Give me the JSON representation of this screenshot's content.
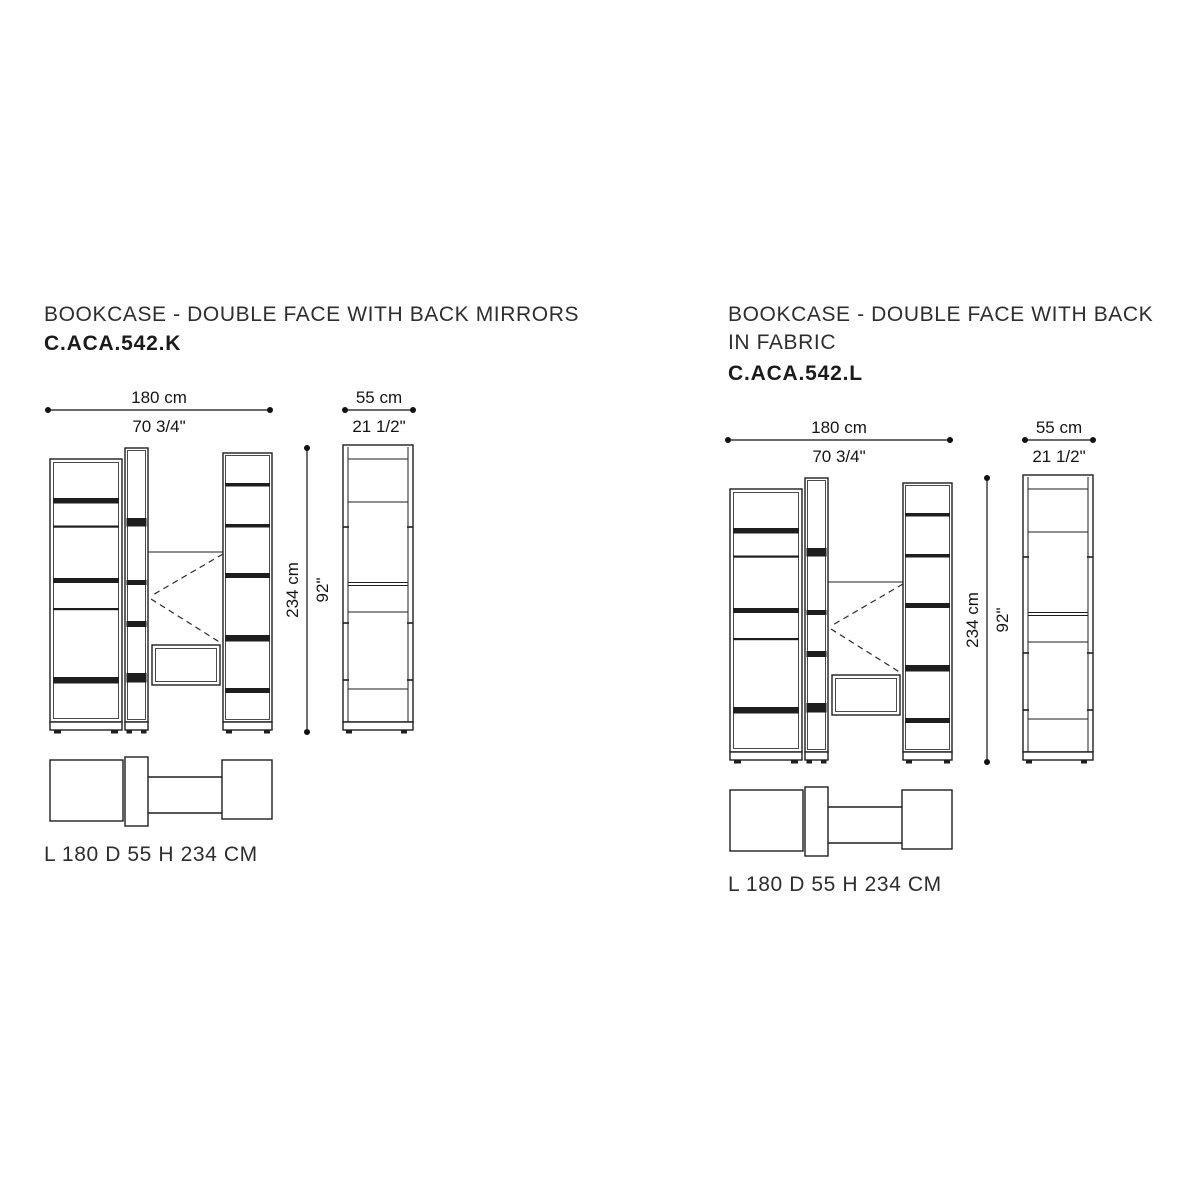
{
  "colors": {
    "ink": "#1e1e1e",
    "background": "#ffffff"
  },
  "panels": [
    {
      "title": "BOOKCASE - DOUBLE FACE WITH BACK MIRRORS",
      "title_lines": [
        "BOOKCASE - DOUBLE FACE WITH BACK MIRRORS"
      ],
      "code": "C.ACA.542.K",
      "dims": {
        "width_cm": "180 cm",
        "width_in": "70 3/4\"",
        "depth_cm": "55 cm",
        "depth_in": "21 1/2\"",
        "height_cm": "234 cm",
        "height_in": "92\""
      },
      "spec": "L 180 D 55 H 234 CM"
    },
    {
      "title": "BOOKCASE - DOUBLE FACE WITH BACK IN FABRIC",
      "title_lines": [
        "BOOKCASE - DOUBLE FACE WITH BACK",
        "IN FABRIC"
      ],
      "code": "C.ACA.542.L",
      "dims": {
        "width_cm": "180 cm",
        "width_in": "70 3/4\"",
        "depth_cm": "55 cm",
        "depth_in": "21 1/2\"",
        "height_cm": "234 cm",
        "height_in": "92\""
      },
      "spec": "L 180 D 55 H 234 CM"
    }
  ]
}
